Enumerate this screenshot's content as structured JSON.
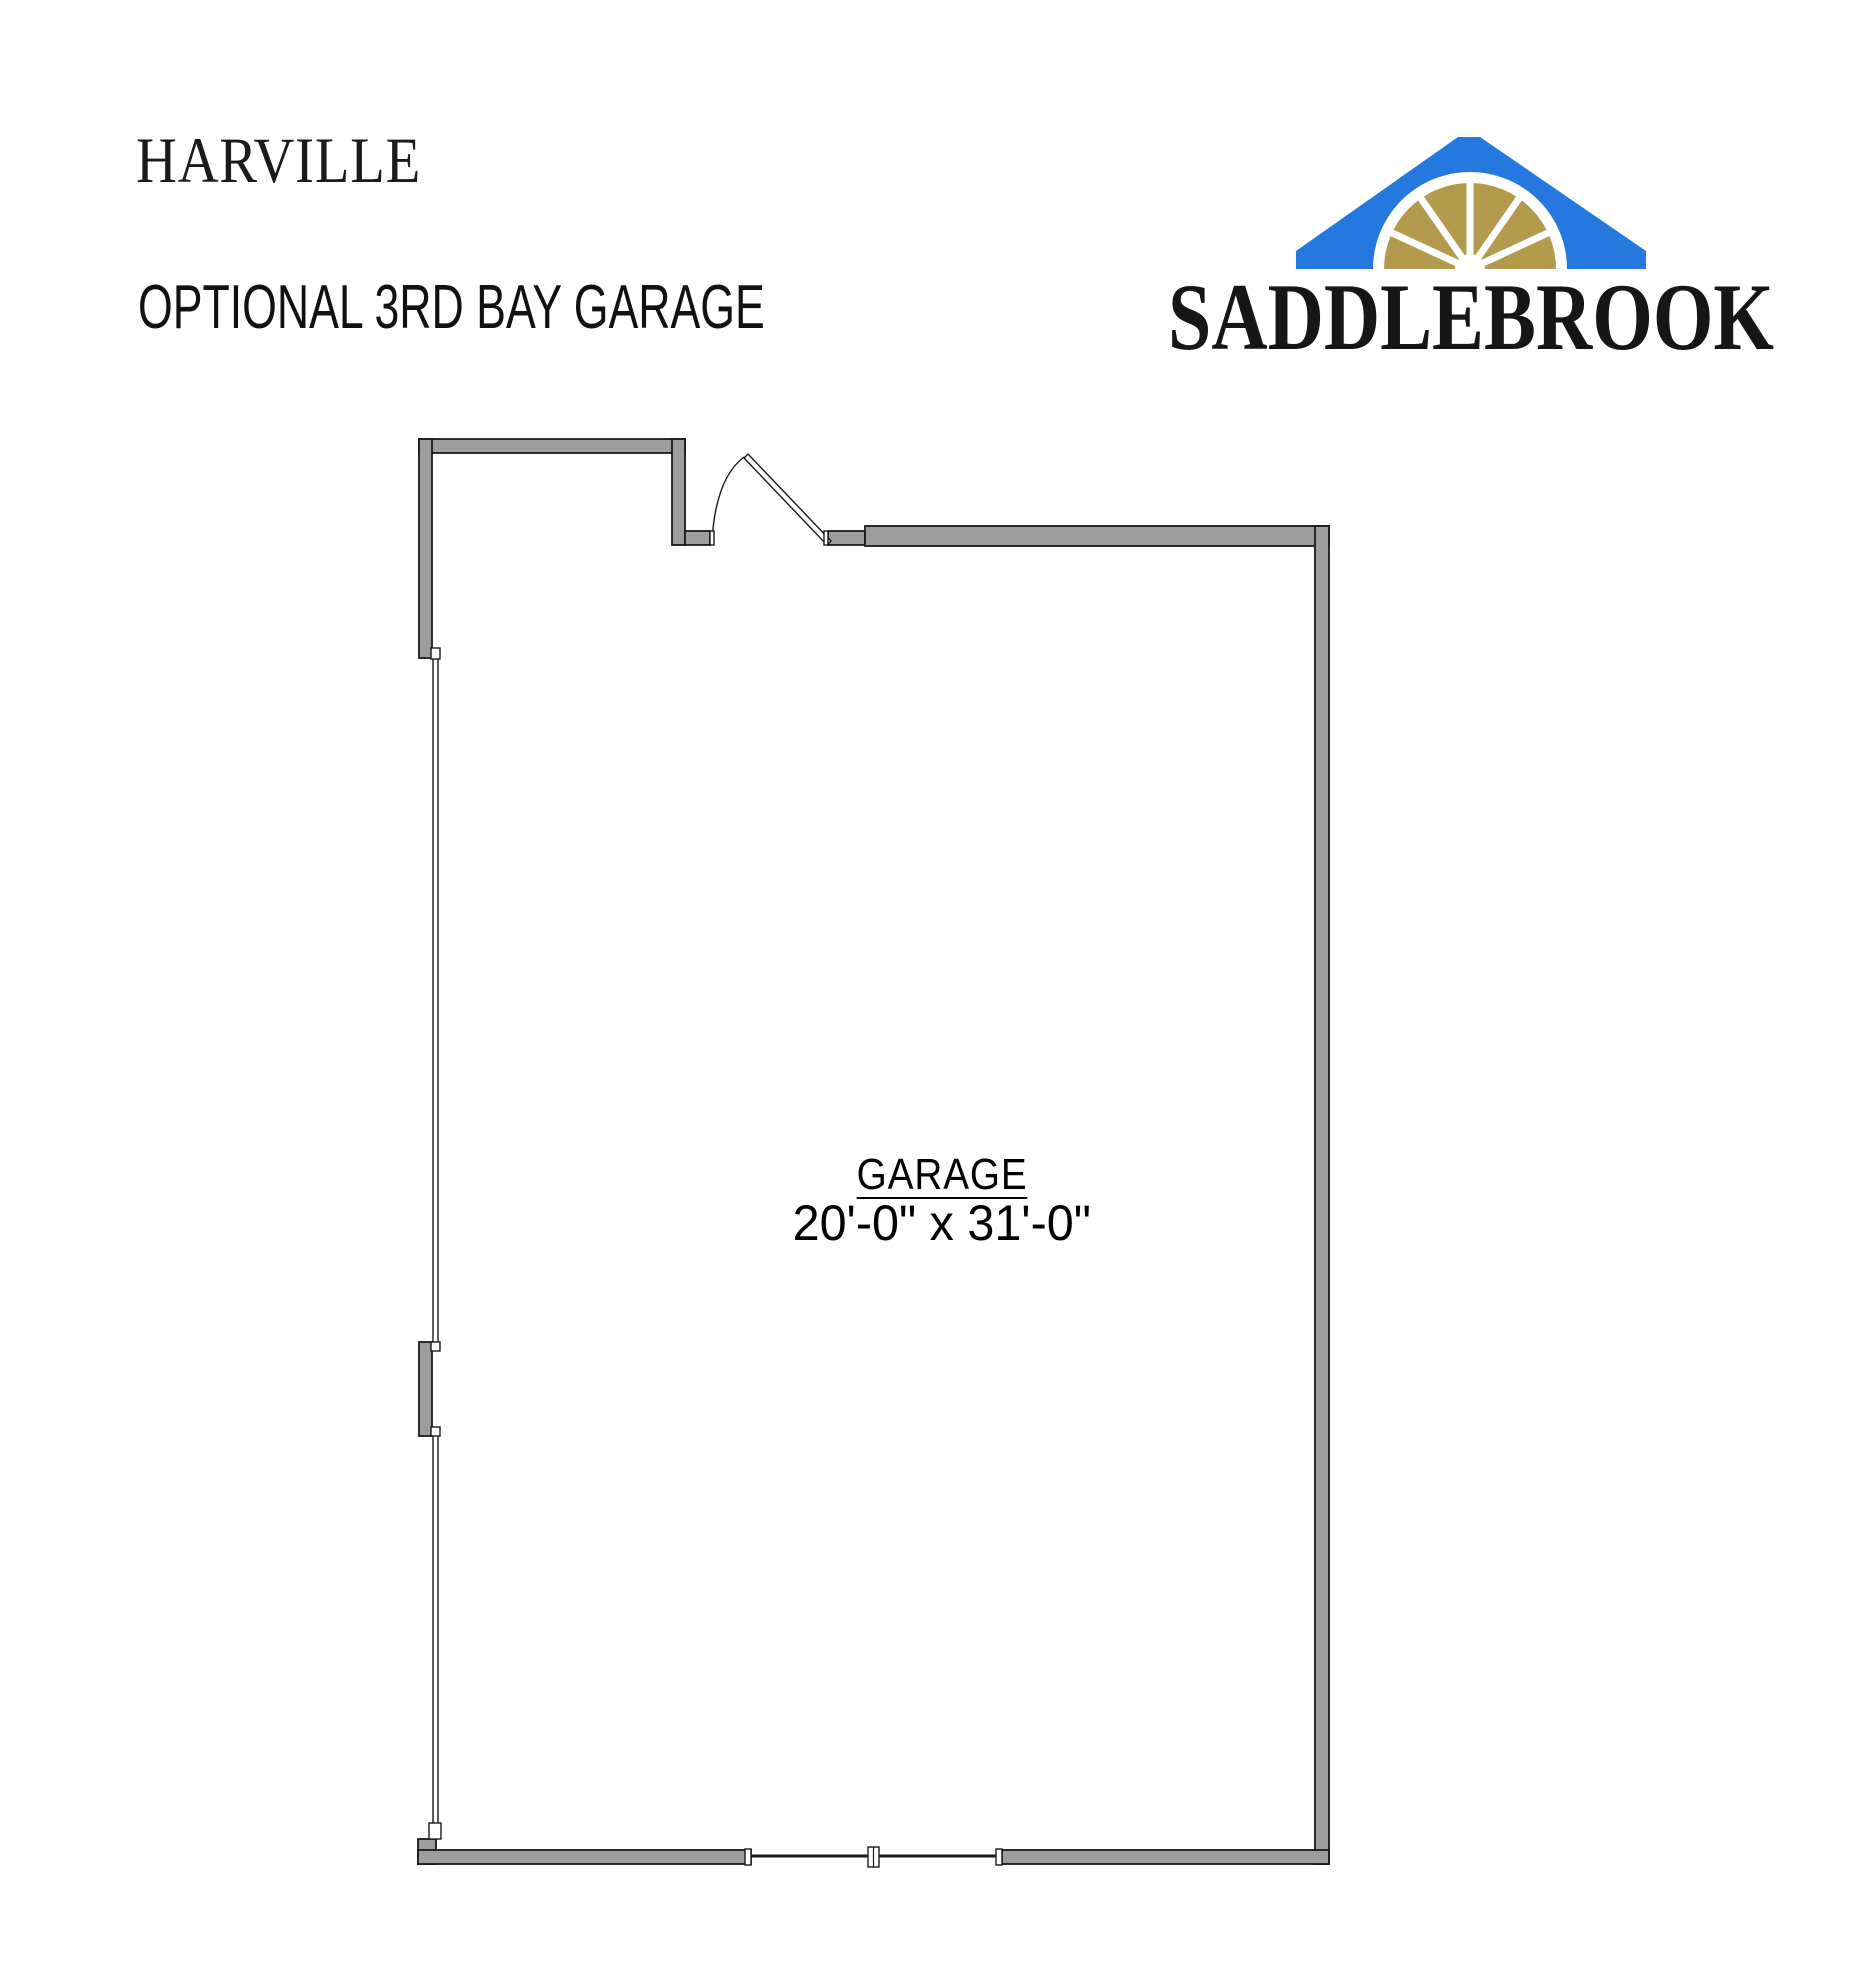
{
  "header": {
    "plan_name": "HARVILLE",
    "option_title": "OPTIONAL 3RD BAY GARAGE"
  },
  "logo": {
    "brand": "SADDLEBROOK",
    "roof_color": "#2478de",
    "fanlight_color": "#b39a4d",
    "text_color": "#161616"
  },
  "floor_plan": {
    "room_label": "GARAGE",
    "room_dimensions": "20'-0\" x 31'-0\"",
    "wall_fill_color": "#9d9d9d",
    "wall_outline_color": "#1a1a1a"
  }
}
